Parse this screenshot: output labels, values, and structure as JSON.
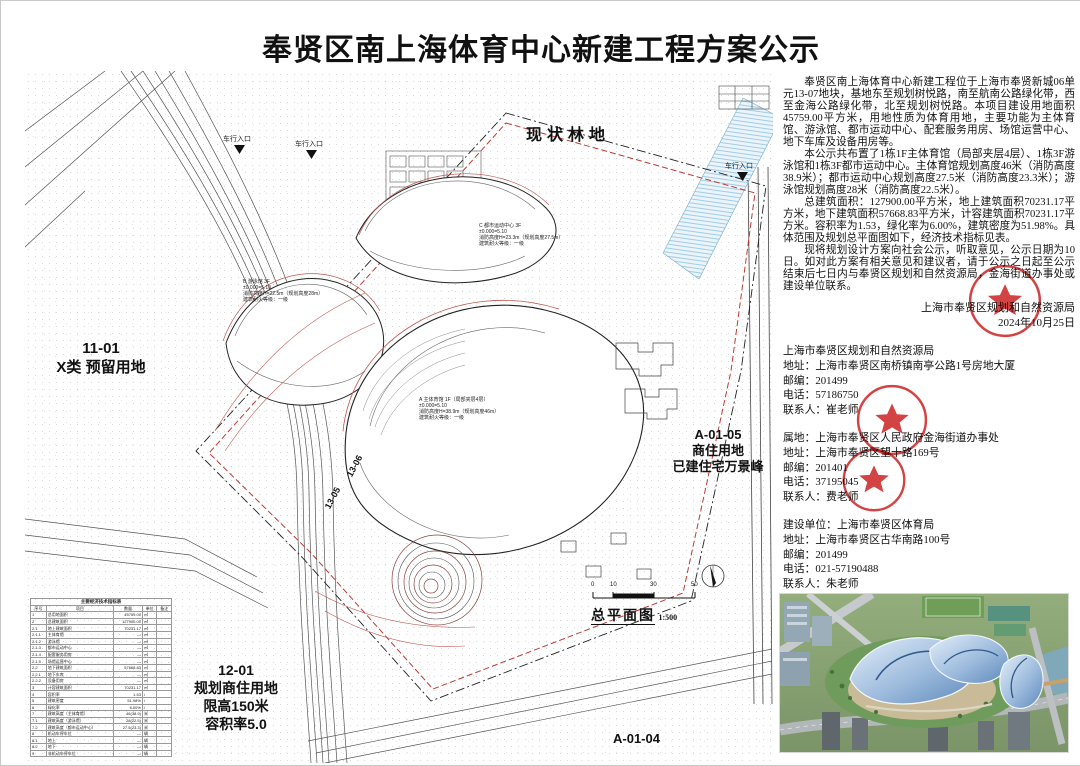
{
  "title": "奉贤区南上海体育中心新建工程方案公示",
  "notice": {
    "paragraphs": [
      "奉贤区南上海体育中心新建工程位于上海市奉贤新城06单元13-07地块，基地东至规划树悦路，南至航南公路绿化带，西至金海公路绿化带，北至规划树悦路。本项目建设用地面积45759.00平方米，用地性质为体育用地，主要功能为主体育馆、游泳馆、都市运动中心、配套服务用房、场馆运营中心、地下车库及设备用房等。",
      "本公示共布置了1栋1F主体育馆（局部夹层4层）、1栋3F游泳馆和1栋3F都市运动中心。主体育馆规划高度46米（消防高度38.9米）；都市运动中心规划高度27.5米（消防高度23.3米）；游泳馆规划高度28米（消防高度22.5米）。",
      "总建筑面积：127900.00平方米，地上建筑面积70231.17平方米，地下建筑面积57668.83平方米，计容建筑面积70231.17平方米。容积率为1.53，绿化率为6.00%，建筑密度为51.98%。具体范围及规划总平面图如下，经济技术指标见表。",
      "现将规划设计方案向社会公示，听取意见，公示日期为10日。如对此方案有相关意见和建议者，请于公示之日起至公示结束后七日内与奉贤区规划和自然资源局，金海街道办事处或建设单位联系。"
    ],
    "signature": "上海市奉贤区规划和自然资源局",
    "date": "2024年10月25日",
    "contacts": [
      {
        "lines": [
          "上海市奉贤区规划和自然资源局",
          "地址：上海市奉贤区南桥镇南亭公路1号房地大厦",
          "邮编：201499",
          "电话：57186750",
          "联系人：崔老师"
        ]
      },
      {
        "lines": [
          "属地：上海市奉贤区人民政府金海街道办事处",
          "地址：上海市奉贤区望十路169号",
          "邮编：201401",
          "电话：37195045",
          "联系人：费老师"
        ]
      },
      {
        "lines": [
          "建设单位：上海市奉贤区体育局",
          "地址：上海市奉贤区古华南路100号",
          "邮编：201499",
          "电话：021-57190488",
          "联系人：朱老师"
        ]
      }
    ]
  },
  "plan": {
    "labels": {
      "forest": "现状林地",
      "entrances": [
        "车行入口",
        "车行入口",
        "车行入口"
      ],
      "zone_11": [
        "11-01",
        "X类 预留用地"
      ],
      "zone_12": [
        "12-01",
        "规划商住用地",
        "限高150米",
        "容积率5.0"
      ],
      "zone_a0105": [
        "A-01-05",
        "商住用地",
        "已建住宅万景峰"
      ],
      "zone_a0104": "A-01-04",
      "road_parcel_1": "13-05",
      "road_parcel_2": "13-06"
    },
    "annotations": [
      {
        "lines": [
          "C 都市运动中心  3F",
          "±0.000=5.10",
          "消防高度H=23.3m（规划高度27.5m）",
          "建筑耐火等级：一级"
        ]
      },
      {
        "lines": [
          "B 游泳馆  3F",
          "±0.000=5.10",
          "消防高度H=22.5m（规划高度28m）",
          "建筑耐火等级：一级"
        ]
      },
      {
        "lines": [
          "A 主体育馆  1F（局部夹层4层）",
          "±0.000=5.10",
          "消防高度H=38.9m（规划高度46m）",
          "建筑耐火等级：一级"
        ]
      }
    ],
    "caption": {
      "name": "总平面图",
      "ratio": "1:500"
    },
    "scale": {
      "ticks": [
        "0",
        "10",
        "30",
        "50"
      ]
    },
    "table": {
      "title": "主要经济技术指标表",
      "headers": [
        "序号",
        "项目",
        "数量",
        "单位",
        "备注"
      ],
      "rows": [
        [
          "1",
          "总用地面积",
          "45759.00",
          "㎡",
          ""
        ],
        [
          "2",
          "总建筑面积",
          "127900.00",
          "㎡",
          ""
        ],
        [
          "2.1",
          "地上建筑面积",
          "70231.17",
          "㎡",
          ""
        ],
        [
          "2.1.1",
          "主体育馆",
          "—",
          "㎡",
          ""
        ],
        [
          "2.1.2",
          "游泳馆",
          "—",
          "㎡",
          ""
        ],
        [
          "2.1.3",
          "都市运动中心",
          "—",
          "㎡",
          ""
        ],
        [
          "2.1.4",
          "配套服务用房",
          "—",
          "㎡",
          ""
        ],
        [
          "2.1.5",
          "场馆运营中心",
          "—",
          "㎡",
          ""
        ],
        [
          "2.2",
          "地下建筑面积",
          "57668.83",
          "㎡",
          ""
        ],
        [
          "2.2.1",
          "地下车库",
          "—",
          "㎡",
          ""
        ],
        [
          "2.2.2",
          "设备用房",
          "—",
          "㎡",
          ""
        ],
        [
          "3",
          "计容建筑面积",
          "70231.17",
          "㎡",
          ""
        ],
        [
          "4",
          "容积率",
          "1.53",
          "/",
          ""
        ],
        [
          "5",
          "建筑密度",
          "51.98%",
          "/",
          ""
        ],
        [
          "6",
          "绿化率",
          "6.00%",
          "/",
          ""
        ],
        [
          "7",
          "建筑高度（主体育馆）",
          "46(38.9)",
          "米",
          ""
        ],
        [
          "7.1",
          "建筑高度（游泳馆）",
          "28(22.5)",
          "米",
          ""
        ],
        [
          "7.2",
          "建筑高度（都市运动中心）",
          "27.5(23.3)",
          "米",
          ""
        ],
        [
          "8",
          "机动车停车位",
          "—",
          "辆",
          ""
        ],
        [
          "8.1",
          "地上",
          "—",
          "辆",
          ""
        ],
        [
          "8.2",
          "地下",
          "—",
          "辆",
          ""
        ],
        [
          "9",
          "非机动车停车位",
          "—",
          "辆",
          ""
        ]
      ]
    }
  },
  "colors": {
    "seal_red": "#cc2222",
    "boundary_red": "#c03a30",
    "water_blue": "#8fc3dd",
    "roof_blue": "#5d89ba"
  }
}
